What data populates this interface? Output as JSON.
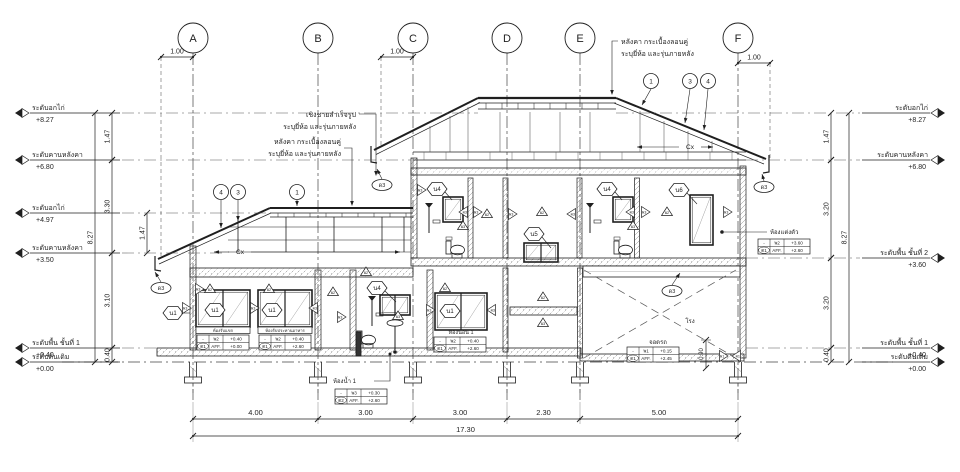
{
  "page": {
    "bg": "#ffffff",
    "ink": "#1f1f1f",
    "faint": "#555555"
  },
  "grid": {
    "labels": [
      "A",
      "B",
      "C",
      "D",
      "E",
      "F"
    ],
    "x": [
      193,
      318,
      413,
      507,
      580,
      738
    ]
  },
  "top_dims": [
    {
      "label": "1.00",
      "x1": 161,
      "x2": 193
    },
    {
      "label": "1.00",
      "x1": 381,
      "x2": 413
    },
    {
      "label": "1.00",
      "x1": 738,
      "x2": 770
    }
  ],
  "levels_left": [
    {
      "name": "ระดับอกไก่",
      "value": "+8.27",
      "y": 113
    },
    {
      "name": "ระดับคานหลังคา",
      "value": "+6.80",
      "y": 160
    },
    {
      "name": "ระดับอกไก่",
      "value": "+4.97",
      "y": 213
    },
    {
      "name": "ระดับคานหลังคา",
      "value": "+3.50",
      "y": 253
    },
    {
      "name": "ระดับพื้น ชั้นที่ 1",
      "value": "+0.40",
      "y": 348
    },
    {
      "name": "ระดับดินเดิม",
      "value": "+0.00",
      "y": 362
    }
  ],
  "levels_right": [
    {
      "name": "ระดับอกไก่",
      "value": "+8.27",
      "y": 113
    },
    {
      "name": "ระดับคานหลังคา",
      "value": "+6.80",
      "y": 160
    },
    {
      "name": "ระดับพื้น ชั้นที่ 2",
      "value": "+3.60",
      "y": 258
    },
    {
      "name": "ระดับพื้น ชั้นที่ 1",
      "value": "+0.40",
      "y": 348
    },
    {
      "name": "ระดับดินเดิม",
      "value": "+0.00",
      "y": 362
    }
  ],
  "vdims_left": [
    {
      "label": "8.27",
      "x": 95,
      "y1": 113,
      "y2": 362
    },
    {
      "label": "1.47",
      "x": 112,
      "y1": 113,
      "y2": 160
    },
    {
      "label": "3.30",
      "x": 112,
      "y1": 160,
      "y2": 253
    },
    {
      "label": "3.10",
      "x": 112,
      "y1": 253,
      "y2": 348
    },
    {
      "label": "0.40",
      "x": 112,
      "y1": 348,
      "y2": 362
    },
    {
      "label": "1.47",
      "x": 147,
      "y1": 213,
      "y2": 253
    }
  ],
  "vdims_right": [
    {
      "label": "8.27",
      "x": 849,
      "y1": 113,
      "y2": 362
    },
    {
      "label": "1.47",
      "x": 831,
      "y1": 113,
      "y2": 160
    },
    {
      "label": "3.20",
      "x": 831,
      "y1": 160,
      "y2": 258
    },
    {
      "label": "3.20",
      "x": 831,
      "y1": 258,
      "y2": 348
    },
    {
      "label": "0.40",
      "x": 831,
      "y1": 348,
      "y2": 362
    }
  ],
  "bottom_dims": {
    "y": 419,
    "segments": [
      {
        "label": "4.00",
        "x1": 193,
        "x2": 318
      },
      {
        "label": "3.00",
        "x1": 318,
        "x2": 413
      },
      {
        "label": "3.00",
        "x1": 413,
        "x2": 507
      },
      {
        "label": "2.30",
        "x1": 507,
        "x2": 580
      },
      {
        "label": "5.00",
        "x1": 580,
        "x2": 738
      }
    ],
    "total": {
      "label": "17.30",
      "x1": 193,
      "x2": 738,
      "y": 436
    }
  },
  "misc_dims": [
    {
      "label": "0.90",
      "x": 706,
      "y1": 340,
      "y2": 368
    }
  ],
  "notes": [
    {
      "id": "note-roof-top",
      "lines": [
        "หลังคา กระเบื้องลอนคู่",
        "ระบุยี่ห้อ และรุ่นภายหลัง"
      ],
      "x": 621,
      "y": 44,
      "anchor": "start"
    },
    {
      "id": "note-fascia",
      "lines": [
        "เชิงชายสำเร็จรูป",
        "ระบุยี่ห้อ และรุ่นภายหลัง"
      ],
      "x": 356,
      "y": 117,
      "anchor": "end"
    },
    {
      "id": "note-roof-left",
      "lines": [
        "หลังคา กระเบื้องลอนคู่",
        "ระบุยี่ห้อ และรุ่นภายหลัง"
      ],
      "x": 341,
      "y": 144,
      "anchor": "end"
    }
  ],
  "room_labels": [
    {
      "text": "ห้องรับแขก",
      "x": 223,
      "y": 332,
      "size": 4.2,
      "anchor": "middle"
    },
    {
      "text": "ห้องรับประทานอาหาร",
      "x": 285,
      "y": 332,
      "size": 4.2,
      "anchor": "middle"
    },
    {
      "text": "ห้องนอน 1",
      "x": 461,
      "y": 334,
      "size": 5.5,
      "anchor": "middle"
    },
    {
      "text": "ห้องน้ำ 1",
      "x": 333,
      "y": 383,
      "size": 6,
      "anchor": "start"
    },
    {
      "text": "ห้องแต่งตัว",
      "x": 770,
      "y": 234,
      "size": 6,
      "anchor": "start"
    },
    {
      "text": "โรง",
      "x": 690,
      "y": 323,
      "size": 6,
      "anchor": "middle"
    },
    {
      "text": "จอดรถ",
      "x": 658,
      "y": 344,
      "size": 6,
      "anchor": "middle"
    }
  ],
  "tables": [
    {
      "x": 197,
      "y": 335,
      "rows": [
        [
          "-",
          "พ2",
          "+0.40"
        ],
        [
          "ด1",
          "AFF.",
          "+0.00"
        ]
      ]
    },
    {
      "x": 259,
      "y": 335,
      "rows": [
        [
          "-",
          "พ2",
          "+0.40"
        ],
        [
          "ด1",
          "AFF.",
          "+2.60"
        ]
      ]
    },
    {
      "x": 434,
      "y": 337,
      "rows": [
        [
          "-",
          "พ2",
          "+0.40"
        ],
        [
          "ด1",
          "AFF.",
          "+2.60"
        ]
      ]
    },
    {
      "x": 335,
      "y": 389,
      "rows": [
        [
          "-",
          "พ3",
          "+0.30"
        ],
        [
          "ด2",
          "AFF.",
          "+2.60"
        ]
      ]
    },
    {
      "x": 758,
      "y": 239,
      "rows": [
        [
          "-",
          "พ2",
          "+3.60"
        ],
        [
          "ด1",
          "AFF.",
          "+2.60"
        ]
      ]
    },
    {
      "x": 627,
      "y": 347,
      "rows": [
        [
          "-",
          "พ1",
          "+0.15"
        ],
        [
          "ด1",
          "AFF.",
          "+2.45"
        ]
      ]
    }
  ],
  "hex_tags": [
    {
      "label": "น1",
      "x": 173,
      "y": 313
    },
    {
      "label": "น1",
      "x": 215,
      "y": 310
    },
    {
      "label": "น1",
      "x": 272,
      "y": 310
    },
    {
      "label": "น1",
      "x": 450,
      "y": 311
    },
    {
      "label": "น4",
      "x": 377,
      "y": 288
    },
    {
      "label": "น4",
      "x": 437,
      "y": 189
    },
    {
      "label": "น4",
      "x": 607,
      "y": 189
    },
    {
      "label": "น5",
      "x": 534,
      "y": 234
    },
    {
      "label": "น6",
      "x": 679,
      "y": 190
    }
  ],
  "circle_tags": [
    {
      "label": "4",
      "x": 221,
      "y": 192
    },
    {
      "label": "3",
      "x": 238,
      "y": 192
    },
    {
      "label": "1",
      "x": 297,
      "y": 192
    },
    {
      "label": "1",
      "x": 651,
      "y": 81
    },
    {
      "label": "3",
      "x": 690,
      "y": 81
    },
    {
      "label": "4",
      "x": 708,
      "y": 81
    }
  ],
  "ellipse_tags": [
    {
      "label": "ด3",
      "x": 161,
      "y": 288
    },
    {
      "label": "ด3",
      "x": 382,
      "y": 185
    },
    {
      "label": "ด3",
      "x": 764,
      "y": 187
    },
    {
      "label": "ด3",
      "x": 672,
      "y": 291
    }
  ],
  "triangle_tags": [
    {
      "label": "ผ2",
      "x": 210,
      "y": 289,
      "dir": "up"
    },
    {
      "label": "ผ2",
      "x": 269,
      "y": 289,
      "dir": "up"
    },
    {
      "label": "ผ3",
      "x": 186,
      "y": 308,
      "dir": "right"
    },
    {
      "label": "ผ3",
      "x": 254,
      "y": 308,
      "dir": "right"
    },
    {
      "label": "ผ3",
      "x": 314,
      "y": 308,
      "dir": "left"
    },
    {
      "label": "ผ2",
      "x": 333,
      "y": 292,
      "dir": "up"
    },
    {
      "label": "ผ3",
      "x": 341,
      "y": 317,
      "dir": "right"
    },
    {
      "label": "ผ2",
      "x": 366,
      "y": 272,
      "dir": "up"
    },
    {
      "label": "ผ3",
      "x": 398,
      "y": 316,
      "dir": "up"
    },
    {
      "label": "ผ2",
      "x": 445,
      "y": 288,
      "dir": "up"
    },
    {
      "label": "ผ3",
      "x": 430,
      "y": 310,
      "dir": "right"
    },
    {
      "label": "ผ3",
      "x": 492,
      "y": 310,
      "dir": "left"
    },
    {
      "label": "ผ2",
      "x": 543,
      "y": 297,
      "dir": "up"
    },
    {
      "label": "ผ3",
      "x": 543,
      "y": 323,
      "dir": "up"
    },
    {
      "label": "ผ1",
      "x": 723,
      "y": 356,
      "dir": "right"
    },
    {
      "label": "ผ1",
      "x": 737,
      "y": 356,
      "dir": "left"
    },
    {
      "label": "ผ3",
      "x": 421,
      "y": 190,
      "dir": "right"
    },
    {
      "label": "ผ2",
      "x": 487,
      "y": 214,
      "dir": "up"
    },
    {
      "label": "ผ3",
      "x": 464,
      "y": 212,
      "dir": "left"
    },
    {
      "label": "ผ3",
      "x": 477,
      "y": 212,
      "dir": "right"
    },
    {
      "label": "ผ2",
      "x": 542,
      "y": 212,
      "dir": "up"
    },
    {
      "label": "ผ3",
      "x": 512,
      "y": 214,
      "dir": "right"
    },
    {
      "label": "ผ3",
      "x": 572,
      "y": 214,
      "dir": "left"
    },
    {
      "label": "ผ3",
      "x": 631,
      "y": 212,
      "dir": "left"
    },
    {
      "label": "ผ3",
      "x": 645,
      "y": 212,
      "dir": "right"
    },
    {
      "label": "ผ2",
      "x": 667,
      "y": 212,
      "dir": "up"
    },
    {
      "label": "ผ3",
      "x": 727,
      "y": 212,
      "dir": "right"
    },
    {
      "label": "ผ3",
      "x": 463,
      "y": 226,
      "dir": "up"
    },
    {
      "label": "ผ3",
      "x": 633,
      "y": 226,
      "dir": "up"
    },
    {
      "label": "ผ3",
      "x": 199,
      "y": 289,
      "dir": "right"
    }
  ],
  "cx_labels": [
    {
      "label": "Cx",
      "x": 240,
      "y": 252
    },
    {
      "label": "Cx",
      "x": 690,
      "y": 147
    }
  ]
}
